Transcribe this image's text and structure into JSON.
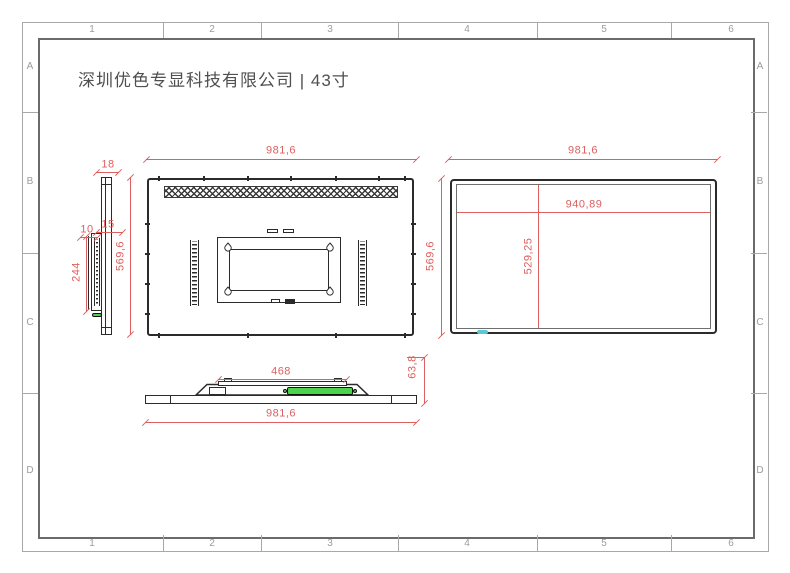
{
  "title": "深圳优色专显科技有限公司 | 43寸",
  "frame": {
    "columns": [
      "1",
      "2",
      "3",
      "4",
      "5",
      "6"
    ],
    "rows": [
      "A",
      "B",
      "C",
      "D"
    ]
  },
  "side_view": {
    "dims": {
      "thickness": "18",
      "lip": "15",
      "offset": "10",
      "box_height": "244",
      "height": "569,6"
    }
  },
  "rear_view": {
    "dims": {
      "width": "981,6"
    }
  },
  "middle": {
    "dims": {
      "height": "569,6"
    }
  },
  "front_view": {
    "dims": {
      "width": "981,6",
      "active_width": "940,89",
      "active_height": "529,25"
    }
  },
  "bottom_view": {
    "dims": {
      "mount_width": "468",
      "width": "981,6",
      "depth": "63,8"
    }
  },
  "colors": {
    "dim_red": "#dd5f5f",
    "line_dark": "#2b2b2b",
    "frame_gray": "#a8a8a8",
    "green": "#4bd44b",
    "cyan": "#5bc8d8",
    "title_text": "#4f4f4f"
  }
}
